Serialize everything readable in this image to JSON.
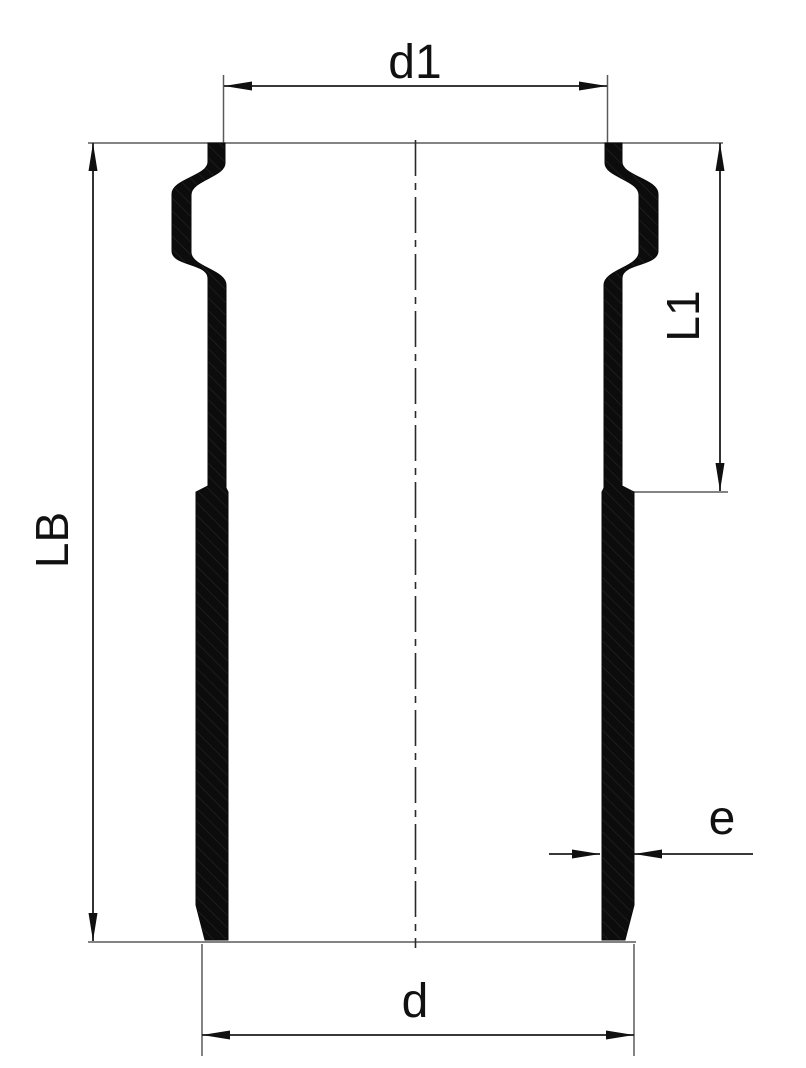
{
  "drawing": {
    "kind": "technical-section-drawing",
    "dimension_labels": {
      "top_inner_diameter": "d1",
      "overall_length": "LB",
      "upper_section_length": "L1",
      "wall_thickness": "e",
      "bottom_outer_diameter": "d"
    },
    "colors": {
      "background": "#ffffff",
      "part_fill": "#0c0c0c",
      "hatch_line": "#2e2e2e",
      "dimension_line": "#1c1c1c",
      "extension_line": "#5a5a5a",
      "label_text": "#111111"
    }
  }
}
